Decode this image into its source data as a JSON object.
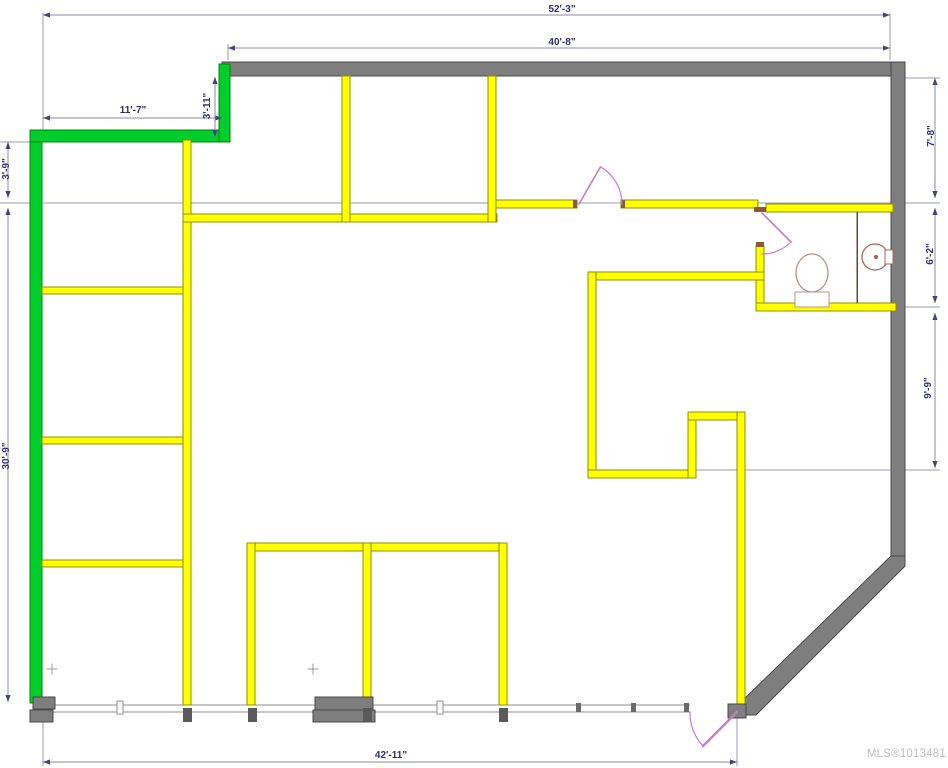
{
  "watermark": "MLS®1013481",
  "colors": {
    "exterior_wall": "#7E7E7E",
    "exterior_outline": "#4A4A4A",
    "interior_wall": "#FFFF00",
    "interior_outline": "#8F8F00",
    "accent_wall": "#00CE2C",
    "accent_outline": "#008800",
    "door": "#C580C5",
    "dimension_text": "#2F2F7A",
    "dimension_line": "#8888AA",
    "watermark_gray": "#BDBDBD"
  },
  "plan": {
    "w": 948,
    "h": 768,
    "layers": [
      {
        "name": "extension-line",
        "type": "line",
        "stroke": "#9B9BB4",
        "width": 0.8,
        "items": [
          [
            0,
            142,
            30,
            142
          ],
          [
            0,
            203,
            940,
            203
          ],
          [
            690,
            470,
            940,
            470
          ],
          [
            896,
            307,
            940,
            307
          ],
          [
            905,
            78,
            940,
            78
          ],
          [
            43,
            13,
            43,
            130
          ],
          [
            890,
            13,
            890,
            60
          ],
          [
            228,
            44,
            228,
            60
          ],
          [
            43,
            710,
            43,
            766
          ],
          [
            737,
            716,
            737,
            766
          ]
        ]
      },
      {
        "name": "window-wall-line",
        "type": "line",
        "stroke": "#8C8C8C",
        "width": 1,
        "items": [
          [
            42,
            705,
            690,
            705
          ],
          [
            30,
            712,
            690,
            712
          ]
        ]
      },
      {
        "name": "exterior-wall",
        "type": "rect",
        "fill": "#7E7E7E",
        "stroke": "#4A4A4A",
        "items": [
          [
            222,
            62,
            683,
            14
          ],
          [
            891,
            62,
            14,
            500
          ]
        ]
      },
      {
        "name": "exterior-wall-diagonal",
        "type": "polygon",
        "fill": "#7E7E7E",
        "stroke": "#4A4A4A",
        "items": [
          [
            891,
            556,
            905,
            556,
            905,
            566,
            756,
            715,
            742,
            715,
            742,
            701
          ]
        ]
      },
      {
        "name": "green-wall",
        "type": "rect",
        "fill": "#00CE2C",
        "stroke": "#008800",
        "items": [
          [
            30,
            130,
            12,
            573
          ],
          [
            30,
            130,
            200,
            12
          ],
          [
            219,
            64,
            11,
            78
          ]
        ]
      },
      {
        "name": "interior-wall",
        "type": "rect",
        "fill": "#FFFF00",
        "stroke": "#8F8F00",
        "items": [
          [
            183,
            140,
            8,
            565
          ],
          [
            42,
            287,
            141,
            7
          ],
          [
            42,
            437,
            141,
            7
          ],
          [
            42,
            560,
            141,
            7
          ],
          [
            183,
            214,
            314,
            8
          ],
          [
            342,
            76,
            8,
            146
          ],
          [
            488,
            76,
            8,
            146
          ],
          [
            496,
            200,
            81,
            8
          ],
          [
            621,
            200,
            137,
            8
          ],
          [
            766,
            204,
            127,
            8
          ],
          [
            756,
            246,
            8,
            65
          ],
          [
            756,
            303,
            140,
            8
          ],
          [
            588,
            272,
            176,
            8
          ],
          [
            588,
            272,
            8,
            206
          ],
          [
            588,
            470,
            108,
            8
          ],
          [
            688,
            412,
            8,
            66
          ],
          [
            688,
            412,
            57,
            8
          ],
          [
            737,
            412,
            8,
            295
          ],
          [
            247,
            543,
            260,
            8
          ],
          [
            247,
            543,
            8,
            162
          ],
          [
            363,
            543,
            8,
            162
          ],
          [
            499,
            543,
            8,
            162
          ]
        ]
      },
      {
        "name": "door-stub-cap",
        "type": "rect",
        "fill": "#8A5A32",
        "items": [
          [
            573,
            200,
            4,
            8
          ],
          [
            621,
            200,
            4,
            8
          ],
          [
            754,
            207,
            12,
            5
          ],
          [
            756,
            242,
            8,
            5
          ]
        ]
      },
      {
        "name": "wall-base-block",
        "type": "rect",
        "fill": "#7E7E7E",
        "stroke": "#4A4A4A",
        "items": [
          [
            33,
            697,
            22,
            12
          ],
          [
            30,
            710,
            23,
            12
          ],
          [
            315,
            697,
            58,
            13
          ],
          [
            313,
            710,
            62,
            12
          ],
          [
            728,
            704,
            18,
            14
          ]
        ]
      },
      {
        "name": "wall-tick",
        "type": "rect",
        "fill": "#5A5A5A",
        "items": [
          [
            183,
            708,
            9,
            14
          ],
          [
            248,
            708,
            9,
            14
          ],
          [
            363,
            708,
            9,
            14
          ],
          [
            499,
            708,
            9,
            14
          ]
        ]
      },
      {
        "name": "window-mullion",
        "type": "rect",
        "fill": "#FFFFFF",
        "stroke": "#8C8C8C",
        "items": [
          [
            117,
            701,
            6,
            13
          ],
          [
            437,
            701,
            6,
            13
          ]
        ]
      },
      {
        "name": "window-tick",
        "type": "rect",
        "fill": "#6A6A6A",
        "items": [
          [
            576,
            703,
            5,
            9
          ],
          [
            631,
            703,
            5,
            9
          ],
          [
            684,
            703,
            5,
            9
          ]
        ]
      },
      {
        "name": "bathroom-partition",
        "type": "line",
        "stroke": "#6B4436",
        "width": 1.5,
        "items": [
          [
            857,
            212,
            857,
            303
          ]
        ]
      },
      {
        "name": "toilet-bowl",
        "type": "ellipse",
        "fill": "#FFFFFF",
        "stroke": "#BB8F8F",
        "width": 1.3,
        "items": [
          [
            812,
            273,
            16,
            19
          ]
        ]
      },
      {
        "name": "toilet-tank",
        "type": "rect",
        "fill": "#FFFFFF",
        "stroke": "#BB8F8F",
        "items": [
          [
            795,
            292,
            34,
            15
          ]
        ]
      },
      {
        "name": "sink",
        "type": "circle",
        "fill": "#FFFFFF",
        "stroke": "#A5695F",
        "width": 1.3,
        "items": [
          [
            875,
            257,
            13
          ]
        ]
      },
      {
        "name": "sink-drain",
        "type": "circle",
        "fill": "#A5695F",
        "items": [
          [
            876,
            257,
            2.2
          ]
        ]
      },
      {
        "name": "sink-tap",
        "type": "rect",
        "fill": "#FFFFFF",
        "stroke": "#A5695F",
        "items": [
          [
            885,
            250,
            8,
            14
          ]
        ]
      },
      {
        "name": "plus-mark",
        "type": "path",
        "stroke": "#9A9A9A",
        "width": 1,
        "items": [
          {
            "d": "M47,669 h10 M52,664 v10"
          },
          {
            "d": "M308,669 h10 M313,664 v10"
          }
        ]
      },
      {
        "name": "door-swing",
        "type": "path",
        "stroke": "#C580C5",
        "width": 1.2,
        "items": [
          {
            "d": "M579,204 L600.5,166.8",
            "w": 1.6
          },
          {
            "d": "M600.5,166.8 A43,43 0 0 1 622,204"
          },
          {
            "d": "M762,213 L791,242",
            "w": 1.6
          },
          {
            "d": "M791,242 A41,41 0 0 1 762,254"
          },
          {
            "d": "M737,712 L703,746",
            "w": 2.4
          },
          {
            "d": "M703,746 A48,48 0 0 1 690,712"
          }
        ]
      }
    ],
    "dimensions": [
      {
        "label": "52'-3\"",
        "o": "h",
        "x1": 43,
        "x2": 890,
        "y": 15,
        "lx": 562,
        "ly": 12
      },
      {
        "label": "40'-8\"",
        "o": "h",
        "x1": 228,
        "x2": 890,
        "y": 48,
        "lx": 562,
        "ly": 45
      },
      {
        "label": "11'-7\"",
        "o": "h",
        "x1": 43,
        "x2": 222,
        "y": 118,
        "lx": 133,
        "ly": 113
      },
      {
        "label": "3'-11\"",
        "o": "v",
        "y1": 77,
        "y2": 137,
        "x": 215,
        "lx": 210,
        "ly": 106
      },
      {
        "label": "3'-9\"",
        "o": "v",
        "y1": 142,
        "y2": 198,
        "x": 8,
        "lx": 9,
        "ly": 169
      },
      {
        "label": "30'-9\"",
        "o": "v",
        "y1": 208,
        "y2": 702,
        "x": 8,
        "lx": 9,
        "ly": 456
      },
      {
        "label": "7'-8\"",
        "o": "v",
        "y1": 78,
        "y2": 198,
        "x": 935,
        "lx": 934,
        "ly": 136
      },
      {
        "label": "6'-2\"",
        "o": "v",
        "y1": 208,
        "y2": 303,
        "x": 935,
        "lx": 933,
        "ly": 254
      },
      {
        "label": "9'-9\"",
        "o": "v",
        "y1": 313,
        "y2": 468,
        "x": 935,
        "lx": 931,
        "ly": 388
      },
      {
        "label": "42'-11\"",
        "o": "h",
        "x1": 43,
        "x2": 737,
        "y": 762,
        "lx": 391,
        "ly": 758
      }
    ]
  }
}
